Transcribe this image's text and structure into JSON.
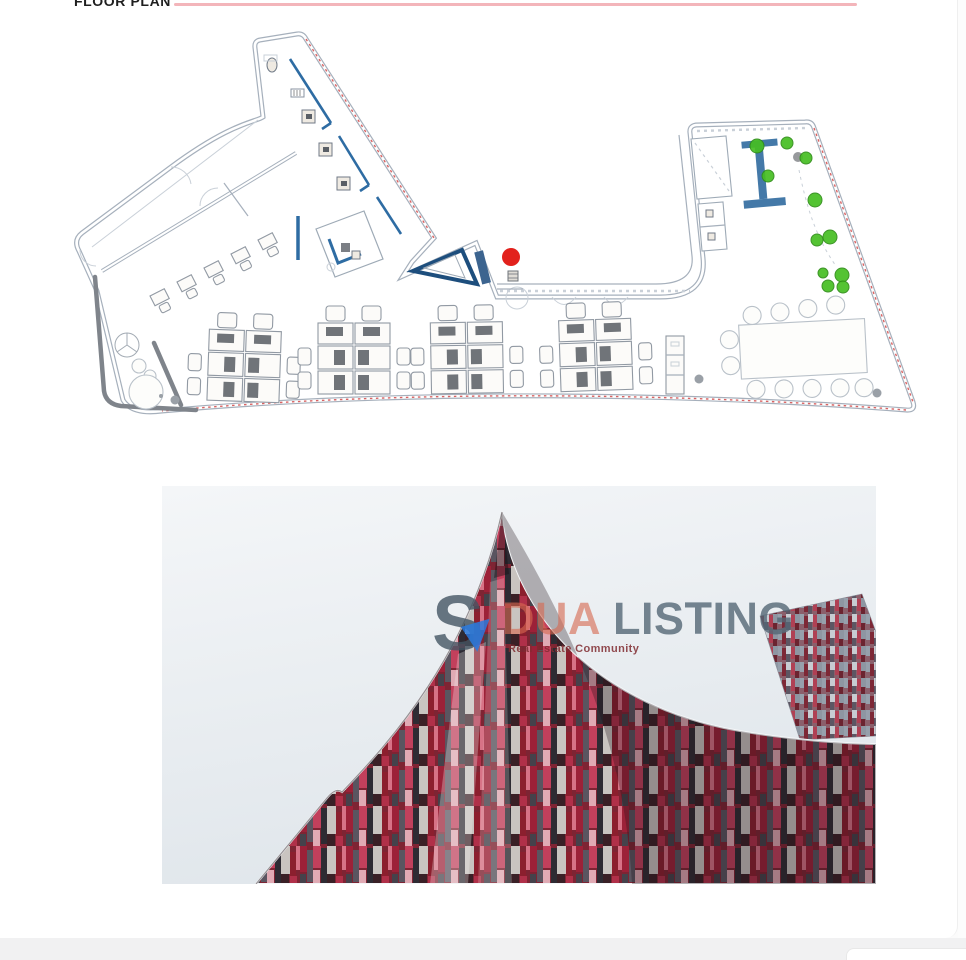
{
  "header": {
    "title": "FLOOR PLAN"
  },
  "watermark": {
    "logo_letter": "S",
    "brand_word1": "DUA",
    "brand_word2": "LISTING",
    "tagline": "Real Estate Community"
  },
  "colors": {
    "title_underline_pink": "#f3b5ba",
    "plan_wall_gray": "#a6b0bc",
    "plan_wall_blue": "#2e6ca3",
    "plan_dashed_red": "#d24848",
    "plan_thick_gray": "#7f848b",
    "plant_green": "#46be22",
    "entrance_marker_red": "#e2211c",
    "brand_blue_gray": "#546676",
    "brand_orange": "#d66950",
    "facade_red": "#9c2138",
    "footer_bar_gray": "#f1f1f2"
  }
}
